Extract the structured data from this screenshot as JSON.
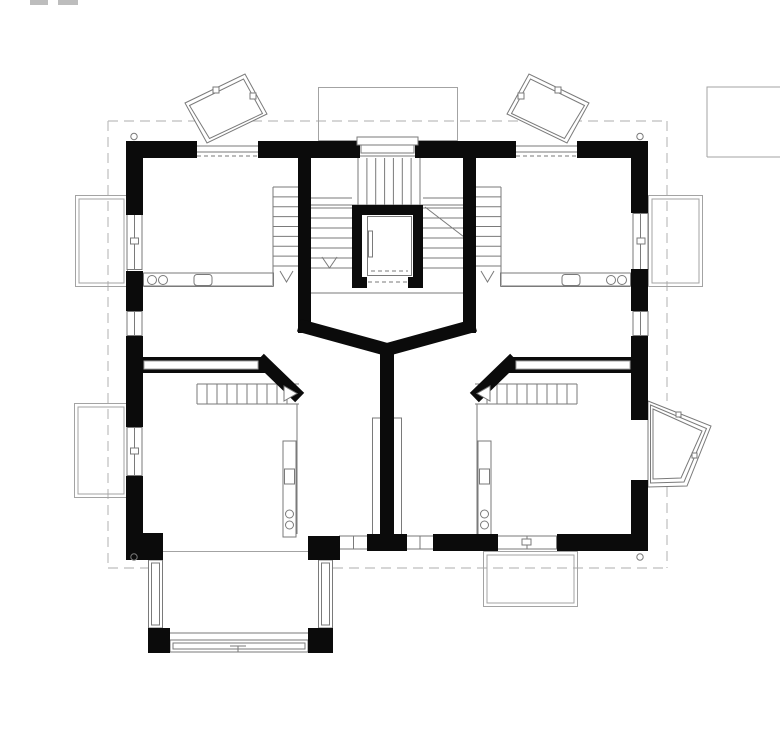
{
  "page": {
    "title": "Residential upper-floor plan drawing",
    "background": "#ffffff"
  },
  "colors": {
    "paper": "#ffffff",
    "wall": "#0b0b0b",
    "line": "#7a7a7a",
    "light_line": "#a3a3a3",
    "dash": "#bdbdbd"
  },
  "plan": {
    "drawing_type": "architectural-floor-plan",
    "rooms": [
      {
        "id": "room-upper-left",
        "features": [
          "twin-basin-vanity",
          "internal-stair-run",
          "balcony-door",
          "angled-dormer-bay"
        ]
      },
      {
        "id": "room-upper-right",
        "features": [
          "twin-basin-vanity",
          "internal-stair-run",
          "balcony-door",
          "angled-dormer-bay"
        ]
      },
      {
        "id": "room-lower-left",
        "features": [
          "counter-with-sink",
          "stair-run",
          "glazed-porch-bay",
          "balcony-door"
        ]
      },
      {
        "id": "room-lower-right",
        "features": [
          "counter-with-sink",
          "stair-run",
          "angled-bay-window",
          "balcony-below"
        ]
      },
      {
        "id": "central-stair-hall",
        "features": [
          "elevator",
          "switchback-stairs",
          "stair-window"
        ]
      }
    ],
    "exterior_features": {
      "balconies": [
        "upper-left",
        "lower-left",
        "upper-right",
        "bottom-center-right"
      ],
      "glazed_bays": [
        "dormer-top-left",
        "dormer-top-center",
        "dormer-top-right",
        "bay-lower-right",
        "porch-bottom-left"
      ],
      "downspouts": 4,
      "roof_overhang": "dashed-outline"
    }
  }
}
